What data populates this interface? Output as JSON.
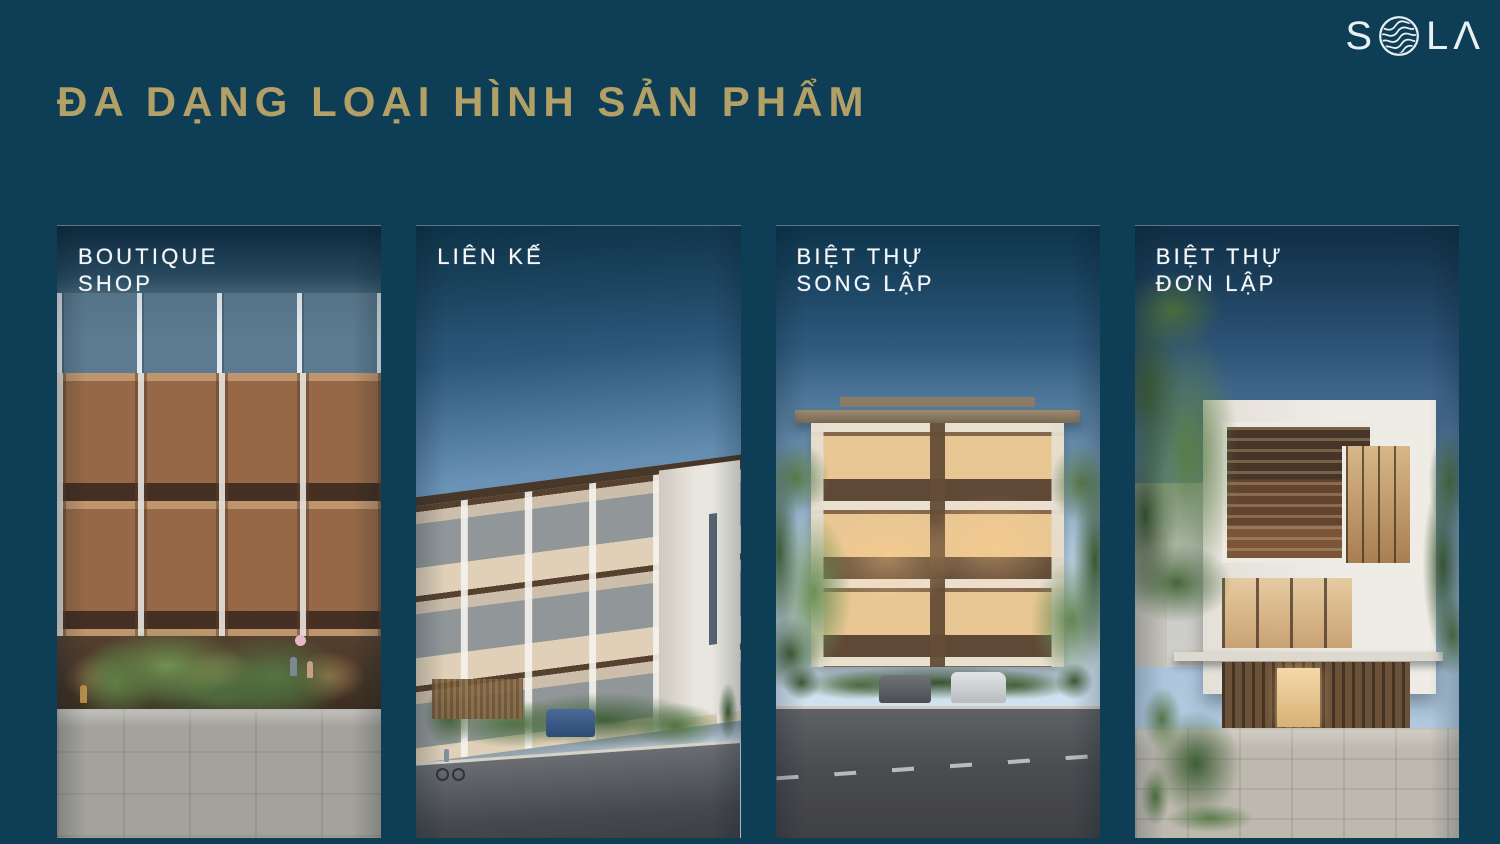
{
  "slide": {
    "background_color": "#0e3e56",
    "title": "ĐA DẠNG LOẠI HÌNH SẢN PHẨM",
    "title_color": "#b2a066",
    "label_color": "#ffffff"
  },
  "logo": {
    "name": "SOLA",
    "letter_s": "S",
    "letter_l": "L",
    "letter_a": "Λ",
    "color": "#e9f0f3"
  },
  "cards": [
    {
      "type": "boutique-shop",
      "label_line1": "BOUTIQUE",
      "label_line2": "SHOP"
    },
    {
      "type": "lien-ke",
      "label_line1": "LIÊN KẾ",
      "label_line2": ""
    },
    {
      "type": "biet-thu-song-lap",
      "label_line1": "BIỆT THỰ",
      "label_line2": "SONG LẬP"
    },
    {
      "type": "biet-thu-don-lap",
      "label_line1": "BIỆT THỰ",
      "label_line2": "ĐƠN LẬP"
    }
  ]
}
